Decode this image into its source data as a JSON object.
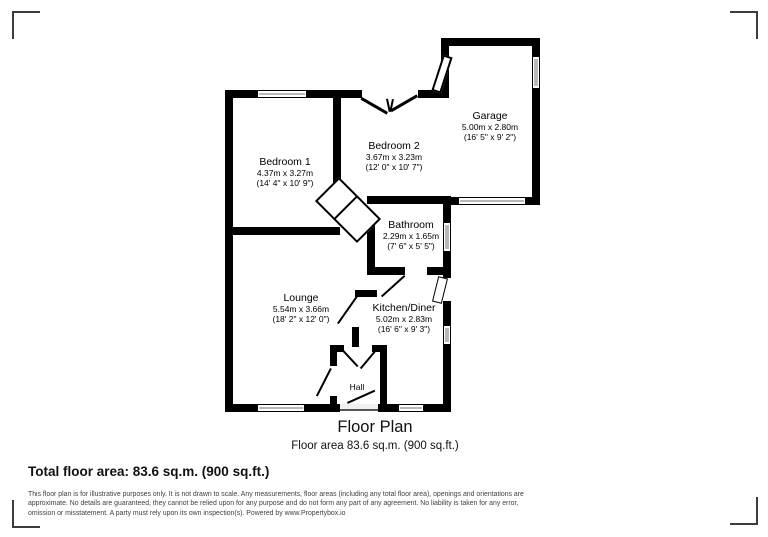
{
  "plan": {
    "rooms": [
      {
        "name": "Bedroom 1",
        "dims_m": "4.37m x 3.27m",
        "dims_ft": "(14' 4\" x 10' 9\")"
      },
      {
        "name": "Bedroom 2",
        "dims_m": "3.67m x 3.23m",
        "dims_ft": "(12' 0\" x 10' 7\")"
      },
      {
        "name": "Garage",
        "dims_m": "5.00m x 2.80m",
        "dims_ft": "(16' 5\" x 9' 2\")"
      },
      {
        "name": "Bathroom",
        "dims_m": "2.29m x 1.65m",
        "dims_ft": "(7' 6\" x 5' 5\")"
      },
      {
        "name": "Lounge",
        "dims_m": "5.54m x 3.66m",
        "dims_ft": "(18' 2\" x 12' 0\")"
      },
      {
        "name": "Kitchen/Diner",
        "dims_m": "5.02m x 2.83m",
        "dims_ft": "(16' 6\" x 9' 3\")"
      },
      {
        "name": "Hall",
        "dims_m": "",
        "dims_ft": ""
      }
    ],
    "colors": {
      "wall": "#000000",
      "window": "#b8b8b8",
      "crop_mark": "#3c3c3c"
    }
  },
  "title_block": {
    "title": "Floor Plan",
    "subtitle": "Floor area 83.6 sq.m. (900 sq.ft.)"
  },
  "footer": {
    "total_area": "Total floor area: 83.6 sq.m. (900 sq.ft.)",
    "disclaimer_lines": [
      "This floor plan is for illustrative purposes only. It is not drawn to scale. Any measurements, floor areas (including any total floor area), openings and orientations are",
      "approximate. No details are guaranteed, they cannot be relied upon for any purpose and do not form any part of any agreement. No liability is taken for any error,",
      "omission or misstatement. A party must rely upon its own inspection(s). Powered by www.Propertybox.io"
    ]
  }
}
